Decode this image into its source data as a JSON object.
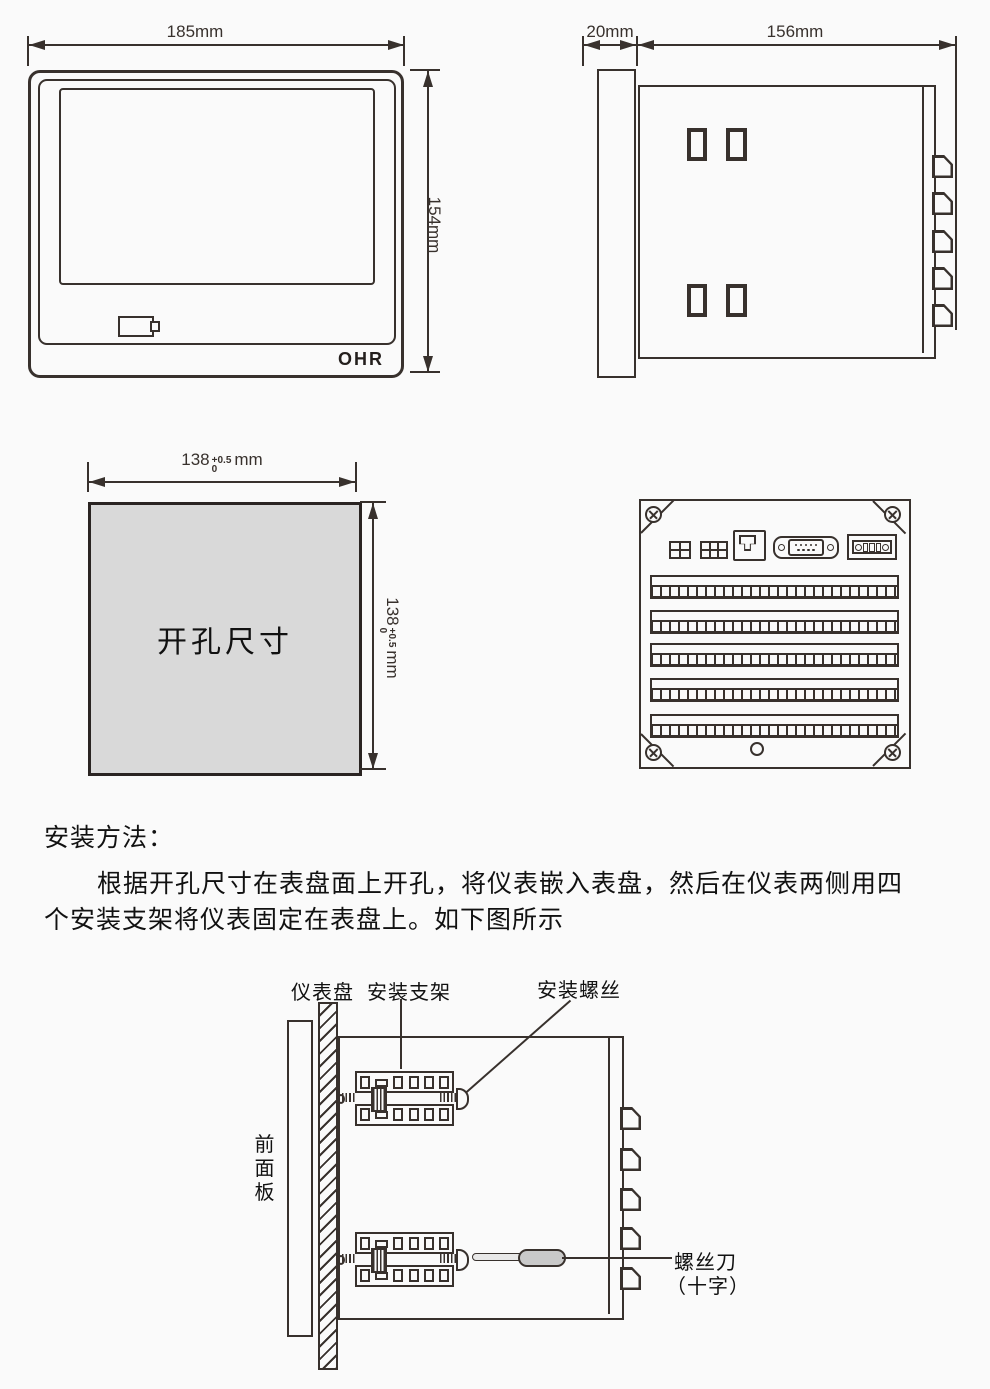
{
  "front_view": {
    "width_dim": "185mm",
    "height_dim": "154mm",
    "logo": "OHR"
  },
  "side_view": {
    "depth_dim": "20mm",
    "length_dim": "156mm"
  },
  "cutout_view": {
    "label": "开孔尺寸",
    "width_dim": {
      "value": "138",
      "tol_plus": "+0.5",
      "tol_minus": "0",
      "unit": "mm"
    },
    "height_dim": {
      "value": "138",
      "tol_plus": "+0.5",
      "tol_minus": "0",
      "unit": "mm"
    }
  },
  "instructions": {
    "heading": "安装方法：",
    "line1": "根据开孔尺寸在表盘面上开孔，将仪表嵌入表盘，然后在仪表两侧用四",
    "line2": "个安装支架将仪表固定在表盘上。如下图所示"
  },
  "install_diagram": {
    "label_panel": "仪表盘",
    "label_bracket": "安装支架",
    "label_screw": "安装螺丝",
    "label_front_panel": "前面板",
    "label_screwdriver": "螺丝刀",
    "label_screwdriver_type": "（十字）"
  },
  "colors": {
    "ink": "#38312d",
    "paper": "#fafafa",
    "cutout_fill": "#d9d9d9",
    "handle_fill": "#c9c9c9"
  }
}
